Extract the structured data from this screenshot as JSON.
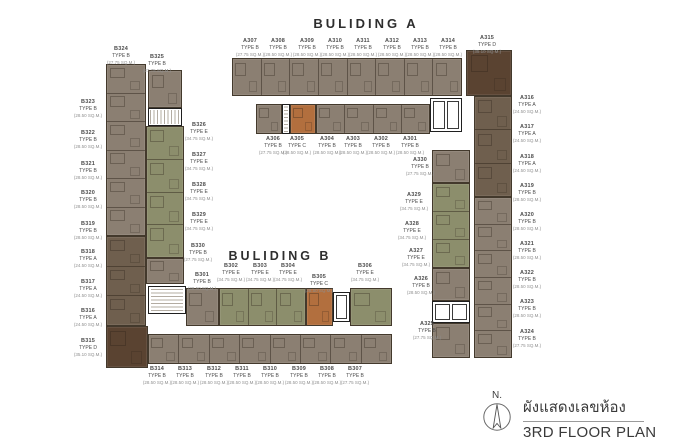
{
  "building_a": {
    "title": "BULIDING A",
    "top_row": [
      {
        "no": "A307",
        "type": "TYPE B",
        "size": "(27.75 SQ.M.)"
      },
      {
        "no": "A308",
        "type": "TYPE B",
        "size": "(28.50 SQ.M.)"
      },
      {
        "no": "A309",
        "type": "TYPE B",
        "size": "(28.50 SQ.M.)"
      },
      {
        "no": "A310",
        "type": "TYPE B",
        "size": "(28.50 SQ.M.)"
      },
      {
        "no": "A311",
        "type": "TYPE B",
        "size": "(28.50 SQ.M.)"
      },
      {
        "no": "A312",
        "type": "TYPE B",
        "size": "(28.50 SQ.M.)"
      },
      {
        "no": "A313",
        "type": "TYPE B",
        "size": "(28.50 SQ.M.)"
      },
      {
        "no": "A314",
        "type": "TYPE B",
        "size": "(28.50 SQ.M.)"
      }
    ],
    "corner": [
      {
        "no": "A315",
        "type": "TYPE D",
        "size": "(35.10 SQ.M.)"
      }
    ],
    "inner_row": [
      {
        "no": "A306",
        "type": "TYPE B",
        "size": "(27.75 SQ.M.)"
      },
      {
        "no": "A305",
        "type": "TYPE C",
        "size": "(28.50 SQ.M.)"
      },
      {
        "no": "A304",
        "type": "TYPE B",
        "size": "(28.50 SQ.M.)"
      },
      {
        "no": "A303",
        "type": "TYPE B",
        "size": "(28.50 SQ.M.)"
      },
      {
        "no": "A302",
        "type": "TYPE B",
        "size": "(28.50 SQ.M.)"
      },
      {
        "no": "A301",
        "type": "TYPE B",
        "size": "(28.50 SQ.M.)"
      }
    ],
    "right_wing_outer": [
      {
        "no": "A316",
        "type": "TYPE A",
        "size": "(24.50 SQ.M.)"
      },
      {
        "no": "A317",
        "type": "TYPE A",
        "size": "(24.50 SQ.M.)"
      },
      {
        "no": "A318",
        "type": "TYPE A",
        "size": "(24.50 SQ.M.)"
      },
      {
        "no": "A319",
        "type": "TYPE B",
        "size": "(28.50 SQ.M.)"
      },
      {
        "no": "A320",
        "type": "TYPE B",
        "size": "(28.50 SQ.M.)"
      },
      {
        "no": "A321",
        "type": "TYPE B",
        "size": "(28.50 SQ.M.)"
      },
      {
        "no": "A322",
        "type": "TYPE B",
        "size": "(28.50 SQ.M.)"
      },
      {
        "no": "A323",
        "type": "TYPE B",
        "size": "(28.50 SQ.M.)"
      },
      {
        "no": "A324",
        "type": "TYPE B",
        "size": "(27.75 SQ.M.)"
      }
    ],
    "right_wing_inner": [
      {
        "no": "A330",
        "type": "TYPE B",
        "size": "(27.75 SQ.M.)"
      },
      {
        "no": "A329",
        "type": "TYPE E",
        "size": "(34.75 SQ.M.)"
      },
      {
        "no": "A328",
        "type": "TYPE E",
        "size": "(34.75 SQ.M.)"
      },
      {
        "no": "A327",
        "type": "TYPE E",
        "size": "(34.75 SQ.M.)"
      },
      {
        "no": "A326",
        "type": "TYPE B",
        "size": "(28.50 SQ.M.)"
      },
      {
        "no": "A325",
        "type": "TYPE B",
        "size": "(27.75 SQ.M.)"
      }
    ]
  },
  "building_b": {
    "title": "BULIDING B",
    "left_wing_top": [
      {
        "no": "B324",
        "type": "TYPE B",
        "size": "(27.75 SQ.M.)"
      },
      {
        "no": "B325",
        "type": "TYPE B",
        "size": "(27.75 SQ.M.)"
      }
    ],
    "left_wing_outer": [
      {
        "no": "B323",
        "type": "TYPE B",
        "size": "(28.50 SQ.M.)"
      },
      {
        "no": "B322",
        "type": "TYPE B",
        "size": "(28.50 SQ.M.)"
      },
      {
        "no": "B321",
        "type": "TYPE B",
        "size": "(28.50 SQ.M.)"
      },
      {
        "no": "B320",
        "type": "TYPE B",
        "size": "(28.50 SQ.M.)"
      },
      {
        "no": "B319",
        "type": "TYPE B",
        "size": "(28.50 SQ.M.)"
      },
      {
        "no": "B318",
        "type": "TYPE A",
        "size": "(24.50 SQ.M.)"
      },
      {
        "no": "B317",
        "type": "TYPE A",
        "size": "(24.50 SQ.M.)"
      },
      {
        "no": "B316",
        "type": "TYPE A",
        "size": "(24.50 SQ.M.)"
      },
      {
        "no": "B315",
        "type": "TYPE D",
        "size": "(35.10 SQ.M.)"
      }
    ],
    "left_wing_inner": [
      {
        "no": "B326",
        "type": "TYPE E",
        "size": "(34.75 SQ.M.)"
      },
      {
        "no": "B327",
        "type": "TYPE E",
        "size": "(34.75 SQ.M.)"
      },
      {
        "no": "B328",
        "type": "TYPE E",
        "size": "(34.75 SQ.M.)"
      },
      {
        "no": "B329",
        "type": "TYPE E",
        "size": "(34.75 SQ.M.)"
      }
    ],
    "bottom_upper": [
      {
        "no": "B330",
        "type": "TYPE B",
        "size": "(27.75 SQ.M.)"
      },
      {
        "no": "B301",
        "type": "TYPE B",
        "size": "(28.50 SQ.M.)"
      },
      {
        "no": "B302",
        "type": "TYPE E",
        "size": "(34.75 SQ.M.)"
      },
      {
        "no": "B303",
        "type": "TYPE E",
        "size": "(34.75 SQ.M.)"
      },
      {
        "no": "B304",
        "type": "TYPE E",
        "size": "(34.75 SQ.M.)"
      },
      {
        "no": "B305",
        "type": "TYPE C",
        "size": "(28.50 SQ.M.)"
      },
      {
        "no": "B306",
        "type": "TYPE E",
        "size": "(34.75 SQ.M.)"
      }
    ],
    "bottom_lower": [
      {
        "no": "B314",
        "type": "TYPE B",
        "size": "(28.50 SQ.M.)"
      },
      {
        "no": "B313",
        "type": "TYPE B",
        "size": "(28.50 SQ.M.)"
      },
      {
        "no": "B312",
        "type": "TYPE B",
        "size": "(28.50 SQ.M.)"
      },
      {
        "no": "B311",
        "type": "TYPE B",
        "size": "(28.50 SQ.M.)"
      },
      {
        "no": "B310",
        "type": "TYPE B",
        "size": "(28.50 SQ.M.)"
      },
      {
        "no": "B309",
        "type": "TYPE B",
        "size": "(28.50 SQ.M.)"
      },
      {
        "no": "B308",
        "type": "TYPE B",
        "size": "(28.50 SQ.M.)"
      },
      {
        "no": "B307",
        "type": "TYPE B",
        "size": "(27.75 SQ.M.)"
      }
    ]
  },
  "footer": {
    "north_label": "N.",
    "plan_title_thai": "ผังแสดงเลขห้อง",
    "plan_title_en": "3RD FLOOR PLAN"
  },
  "icons": {
    "compass": "north-compass-circle-with-needle"
  },
  "colors": {
    "type_a": "#6f5f4e",
    "type_b": "#8b7f72",
    "type_c": "#b26f3e",
    "type_d": "#5a4331",
    "type_e": "#8c8e6c"
  }
}
